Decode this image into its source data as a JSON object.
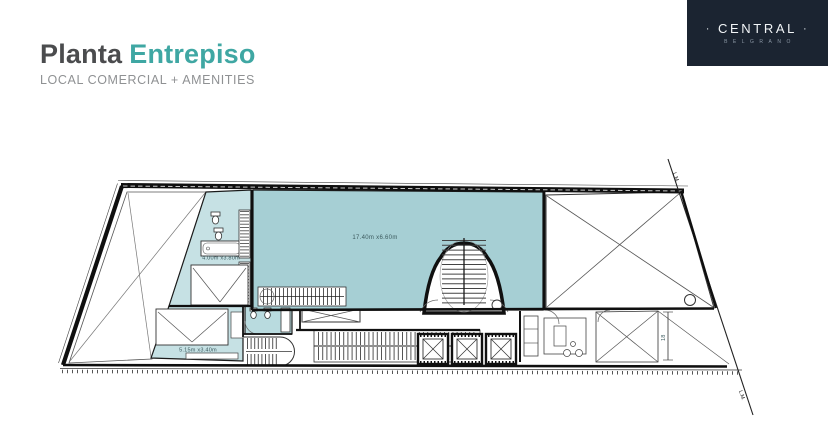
{
  "header": {
    "title": {
      "primary": "Planta",
      "accent": "Entrepiso"
    },
    "subtitle": "LOCAL COMERCIAL + AMENITIES",
    "colors": {
      "primary": "#4b4c4e",
      "accent": "#3fa7a3",
      "subtitle": "#8f9193"
    }
  },
  "logo": {
    "dot_left": "·",
    "name": "CENTRAL",
    "dot_right": "·",
    "tagline": "BELGRANO",
    "colors": {
      "background": "#1b2431",
      "name": "#f2f5f7",
      "tagline": "#8b97a4"
    }
  },
  "floor_plan": {
    "rooms": {
      "main_hall": {
        "label": "17.40m x6.60m"
      },
      "suite": {
        "label": "4.00m x3.80m"
      },
      "bedroom": {
        "label": "5.15m x3.40m"
      }
    },
    "annotations": {
      "property_line_top": "L.M.",
      "property_line_bottom": "L.M.",
      "dimension": "18"
    },
    "colors": {
      "hall_fill": "#a6cfd4",
      "room_fill": "#c6e1e4",
      "bath_fill": "#b9dbdf",
      "wall": "#101010",
      "line": "#444444",
      "light_line": "#888888",
      "label": "#3c5a5e"
    }
  }
}
